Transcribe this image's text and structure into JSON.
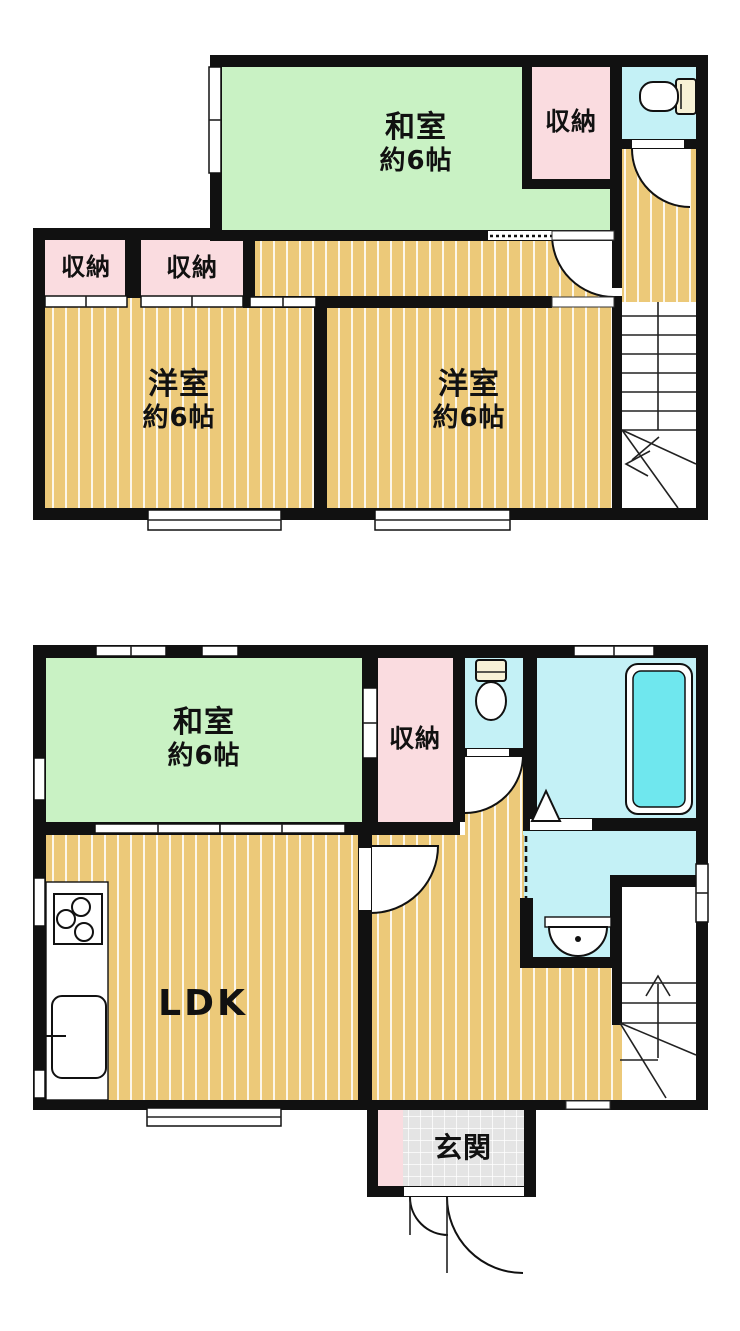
{
  "document_type": "floor-plan",
  "colors": {
    "wall": "#111111",
    "tatami": "#c9f2c4",
    "wood": "#ecc979",
    "closet": "#fadce0",
    "wet": "#c4f1f6",
    "bathtub": "#6fe7ee",
    "tile": "#e4e4e4",
    "outline": "#222222"
  },
  "floor2": {
    "washitsu": {
      "name": "和室",
      "area": "約6帖"
    },
    "oshiire_top": {
      "name": "収納"
    },
    "oshiire_left": {
      "name": "収納"
    },
    "oshiire_mid": {
      "name": "収納"
    },
    "youshitsu_left": {
      "name": "洋室",
      "area": "約6帖"
    },
    "youshitsu_right": {
      "name": "洋室",
      "area": "約6帖"
    }
  },
  "floor1": {
    "washitsu": {
      "name": "和室",
      "area": "約6帖"
    },
    "oshiire": {
      "name": "収納"
    },
    "ldk": {
      "name": "LDK"
    },
    "genkan": {
      "name": "玄関"
    }
  }
}
